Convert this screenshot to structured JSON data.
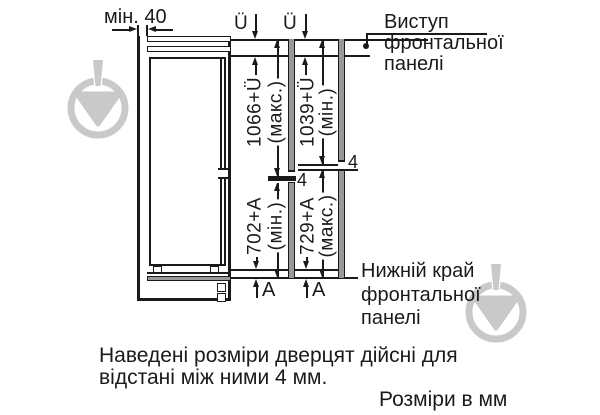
{
  "diagram": {
    "min_gap_label": "мін. 40",
    "overhang_symbol_left": "Ü",
    "overhang_symbol_right": "Ü",
    "front_panel_callout": {
      "lines": [
        "Виступ",
        "фронтальної",
        "панелі"
      ]
    },
    "lower_edge_callout": {
      "lines": [
        "Нижній край",
        "фронтальної",
        "панелі"
      ]
    },
    "dims": {
      "upper_left": {
        "value": "1066+Ü",
        "qual": "(макс.)"
      },
      "upper_right": {
        "value": "1039+Ü",
        "qual": "(мін.)"
      },
      "lower_left": {
        "value": "702+A",
        "qual": "(мін.)"
      },
      "lower_right": {
        "value": "729+A",
        "qual": "(макс.)"
      }
    },
    "door_gap_left": "4",
    "door_gap_right": "4",
    "offset_symbol_left": "A",
    "offset_symbol_right": "A"
  },
  "caption": {
    "line1": "Наведені розміри дверцят дійсні для",
    "line2": "відстані між ними 4 мм.",
    "units_note": "Розміри в мм"
  },
  "colors": {
    "ink": "#1a1a1a",
    "panel_gray": "#999999",
    "watermark": "#c9c9c9",
    "background": "#ffffff"
  }
}
